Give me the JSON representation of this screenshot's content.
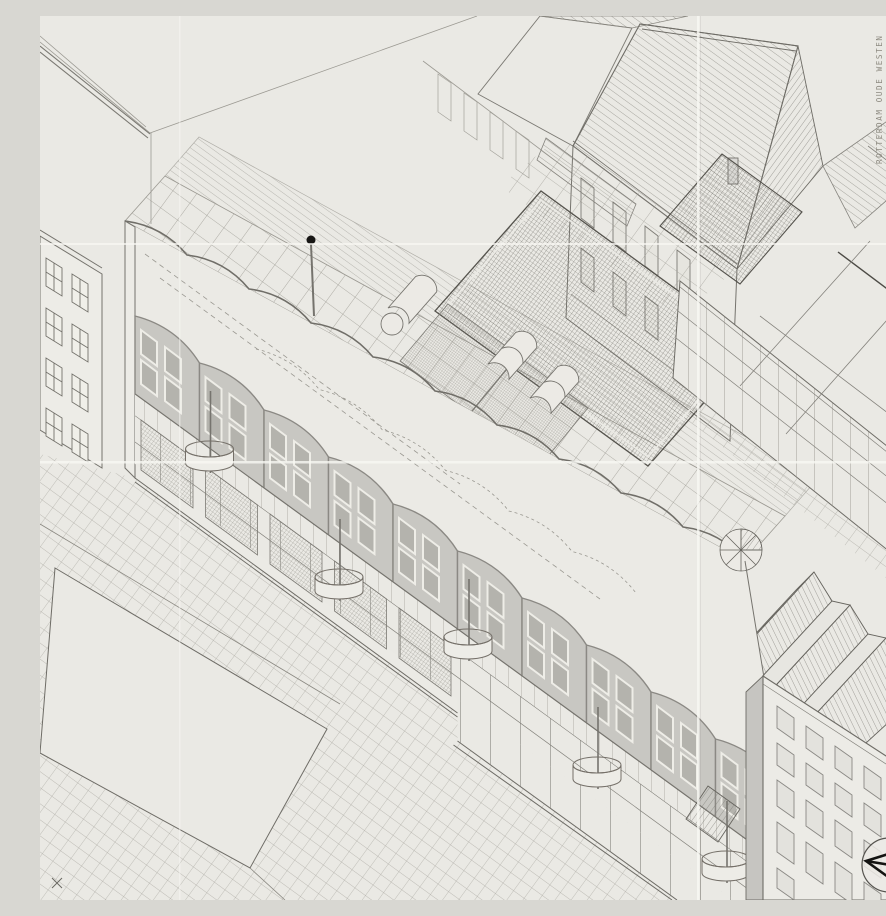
{
  "document": {
    "kind": "scanned axonometric architectural drawing",
    "project": "housing block with school and neighbourhood centre, Rotterdam Oude Westen",
    "projection": "isometrie (axonometric), pen on paper with fold creases"
  },
  "title_block": {
    "orientation": "rotated 90°, reads bottom-to-top, top-right corner",
    "lines": [
      "ROTTERDAM  OUDE  WESTEN",
      "SCHOOL + BUURTGEBOUW + WONINGEN",
      "ISOMETRIE  DEFINITIEF  ONTWERP",
      "GIROD + GROENEVELD  ARCHITECTEN",
      "DEC '80 · SCHAAL 1:100 · JP GIROD / J DE JONG"
    ]
  },
  "compass": {
    "symbol": "north arrow in circle",
    "position": "bottom-right corner"
  },
  "colors": {
    "paper": "#eae9e4",
    "ink": "#6e6c66",
    "ink_dark": "#43413c",
    "ink_black": "#171614",
    "shaded_bay": "#c8c7c2",
    "glass": "#b4b3ad",
    "crease": "#f6f5f1"
  },
  "scene": {
    "elements": [
      "left neighbour facade with four-pane windows",
      "flat roof plane of neighbour block, top-left",
      "long housing block with scalloped wavy parapet and grey window bays",
      "cylindrical balconies on rods",
      "ground-floor gallery with posts and mesh screens",
      "tiled terrace band and glazed roof strip",
      "dark cross-hatched school roof with barrel-vault skylights",
      "stippled roof panels and spiral stair",
      "pitched-roof perimeter buildings with line hatching",
      "sawtooth (zigzag) roofs, lower right",
      "existing facade with grid of windows, bottom-right",
      "street paving grid and empty plaza parallelogram",
      "flagpole with ball finial",
      "fold creases of the scanned sheet"
    ]
  }
}
